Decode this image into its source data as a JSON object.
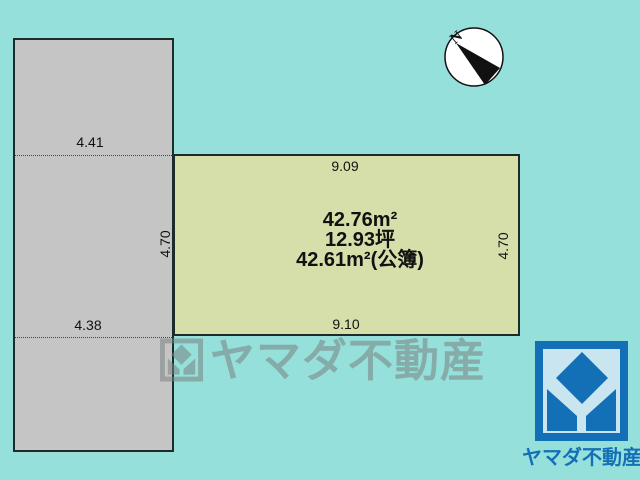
{
  "colors": {
    "background": "#96E0DB",
    "lot_gray": "#C5C5C5",
    "lot_yellow": "#D6DFAA",
    "line_dark": "#1E2B2B",
    "brand_blue": "#1470B6",
    "logo_inner": "#C9E5EF",
    "watermark_gray": "rgba(122,130,130,0.55)",
    "text_dark": "#111111"
  },
  "compass": {
    "north_label": "N"
  },
  "lots": {
    "adjacent": {
      "top_width": "4.41",
      "bottom_width": "4.38",
      "side_depth": "4.70"
    },
    "property": {
      "top_width": "9.09",
      "bottom_width": "9.10",
      "side_depth": "4.70",
      "area": {
        "sqm": "42.76m²",
        "tsubo": "12.93坪",
        "registered": "42.61m²(公簿)"
      }
    }
  },
  "watermark": {
    "text": "ヤマダ不動産"
  },
  "brand": {
    "name": "ヤマダ不動産"
  }
}
